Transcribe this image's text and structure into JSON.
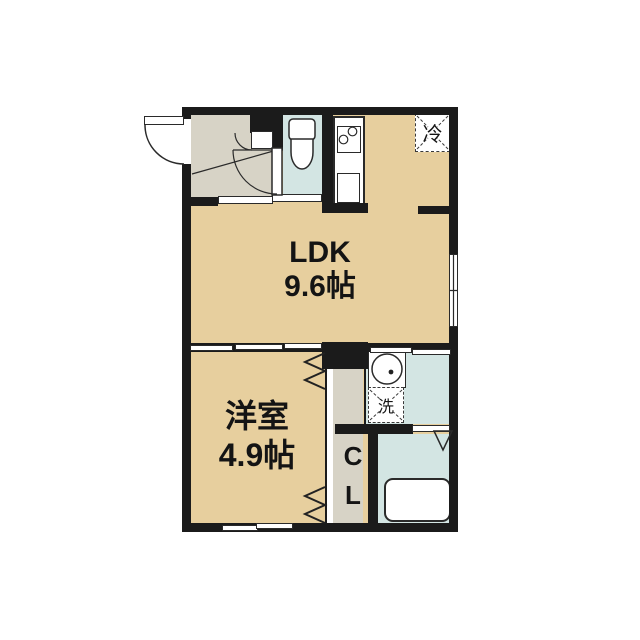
{
  "rooms": {
    "ldk": {
      "name_label": "LDK",
      "size_label": "9.6帖"
    },
    "western_room": {
      "name_label": "洋室",
      "size_label": "4.9帖"
    },
    "closet": {
      "line1": "C",
      "line2": "L"
    },
    "refrigerator_space": {
      "label": "冷"
    },
    "washer_space": {
      "label": "洗"
    }
  },
  "icons": [
    "toilet-icon",
    "washbasin-icon",
    "stove-burners-icon",
    "sink-icon",
    "bathtub-icon",
    "door-swing-arc-icon",
    "folding-door-zigzag-icon",
    "sliding-door-panel",
    "sliding-window-icon",
    "door-swing-triangle-icon"
  ],
  "colors": {
    "wall": "#1b1b1b",
    "tan": "#e7cf9e",
    "gray": "#d7d3c6",
    "blue": "#d3e5e3",
    "line": "#2a2a2a",
    "white": "#ffffff"
  }
}
